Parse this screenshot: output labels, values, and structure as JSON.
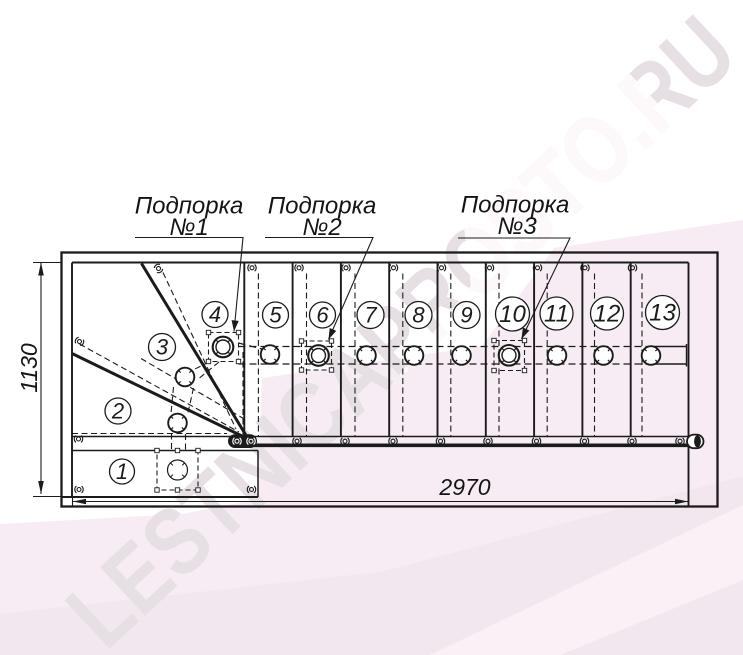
{
  "watermark": {
    "text": "LESTNICAPROSTO.RU"
  },
  "supports": [
    {
      "line1": "Подпорка",
      "line2": "№1"
    },
    {
      "line1": "Подпорка",
      "line2": "№2"
    },
    {
      "line1": "Подпорка",
      "line2": "№3"
    }
  ],
  "dimensions": {
    "height_label": "1130",
    "width_label": "2970"
  },
  "steps": [
    {
      "number": "1"
    },
    {
      "number": "2"
    },
    {
      "number": "3"
    },
    {
      "number": "4"
    },
    {
      "number": "5"
    },
    {
      "number": "6"
    },
    {
      "number": "7"
    },
    {
      "number": "8"
    },
    {
      "number": "9"
    },
    {
      "number": "10"
    },
    {
      "number": "11"
    },
    {
      "number": "12"
    },
    {
      "number": "13"
    }
  ],
  "colors": {
    "line": "#1b1b1b",
    "background_pink": "#f7ecf4",
    "background_pink_dark": "#f3e7ef",
    "watermark_gray": "#e6dfe4"
  }
}
